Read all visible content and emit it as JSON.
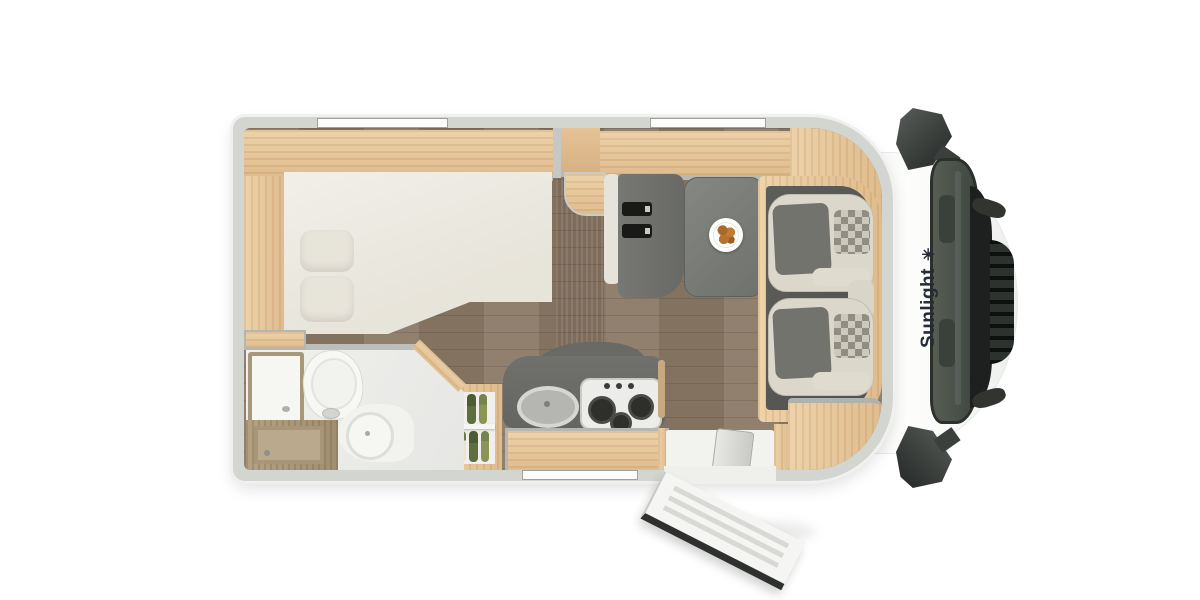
{
  "scene": {
    "description": "Top-down 3D rendered floor plan of a Sunlight motorhome with rear french bed, bathroom, kitchen, dinette and swivelled cab seats",
    "background": "#ffffff"
  },
  "brand": {
    "label": "Sunlight",
    "logo_glyph": "✳",
    "text_color": "#262b34"
  },
  "palette": {
    "body_white": "#f6f7f6",
    "wall_gray": "#d3d5d1",
    "wood_light_oak": "#e6c79c",
    "wood_taupe": "#a79678",
    "floor_brown": "#8c7967",
    "counter_dark": "#6a6b67",
    "cab_floor_dark": "#585854",
    "seat_cream": "#dbd7ca",
    "seat_gray": "#73736d",
    "table_gray": "#7b7d79",
    "mattress_cream": "#edebe2",
    "windshield_green_gray": "#49504a",
    "grille_dark": "#272a27",
    "mirror_dark": "#2c302b",
    "carrot_orange": "#c97931",
    "leek_green": "#6d7c49",
    "croissant_brown": "#b5732c"
  },
  "features": [
    "double-bed",
    "pillows",
    "overhead-cabinets",
    "rear-wardrobe-band",
    "tall-gray-column",
    "dinette-bench-with-seatbelts",
    "dinette-table",
    "plate-of-croissants",
    "swivel-cab-seat-left",
    "swivel-cab-seat-right",
    "kitchen-counter",
    "round-sink",
    "gas-hob-3-burner",
    "kitchen-drawer",
    "fridge-pantry-with-vegetables",
    "bathroom",
    "toilet",
    "washbasin",
    "shower-tray",
    "bathroom-door",
    "entry-step",
    "entry-door-open",
    "roof-window-bed",
    "roof-window-dinette",
    "kitchen-window",
    "side-mirror-top",
    "side-mirror-bottom",
    "windshield",
    "front-grille"
  ]
}
